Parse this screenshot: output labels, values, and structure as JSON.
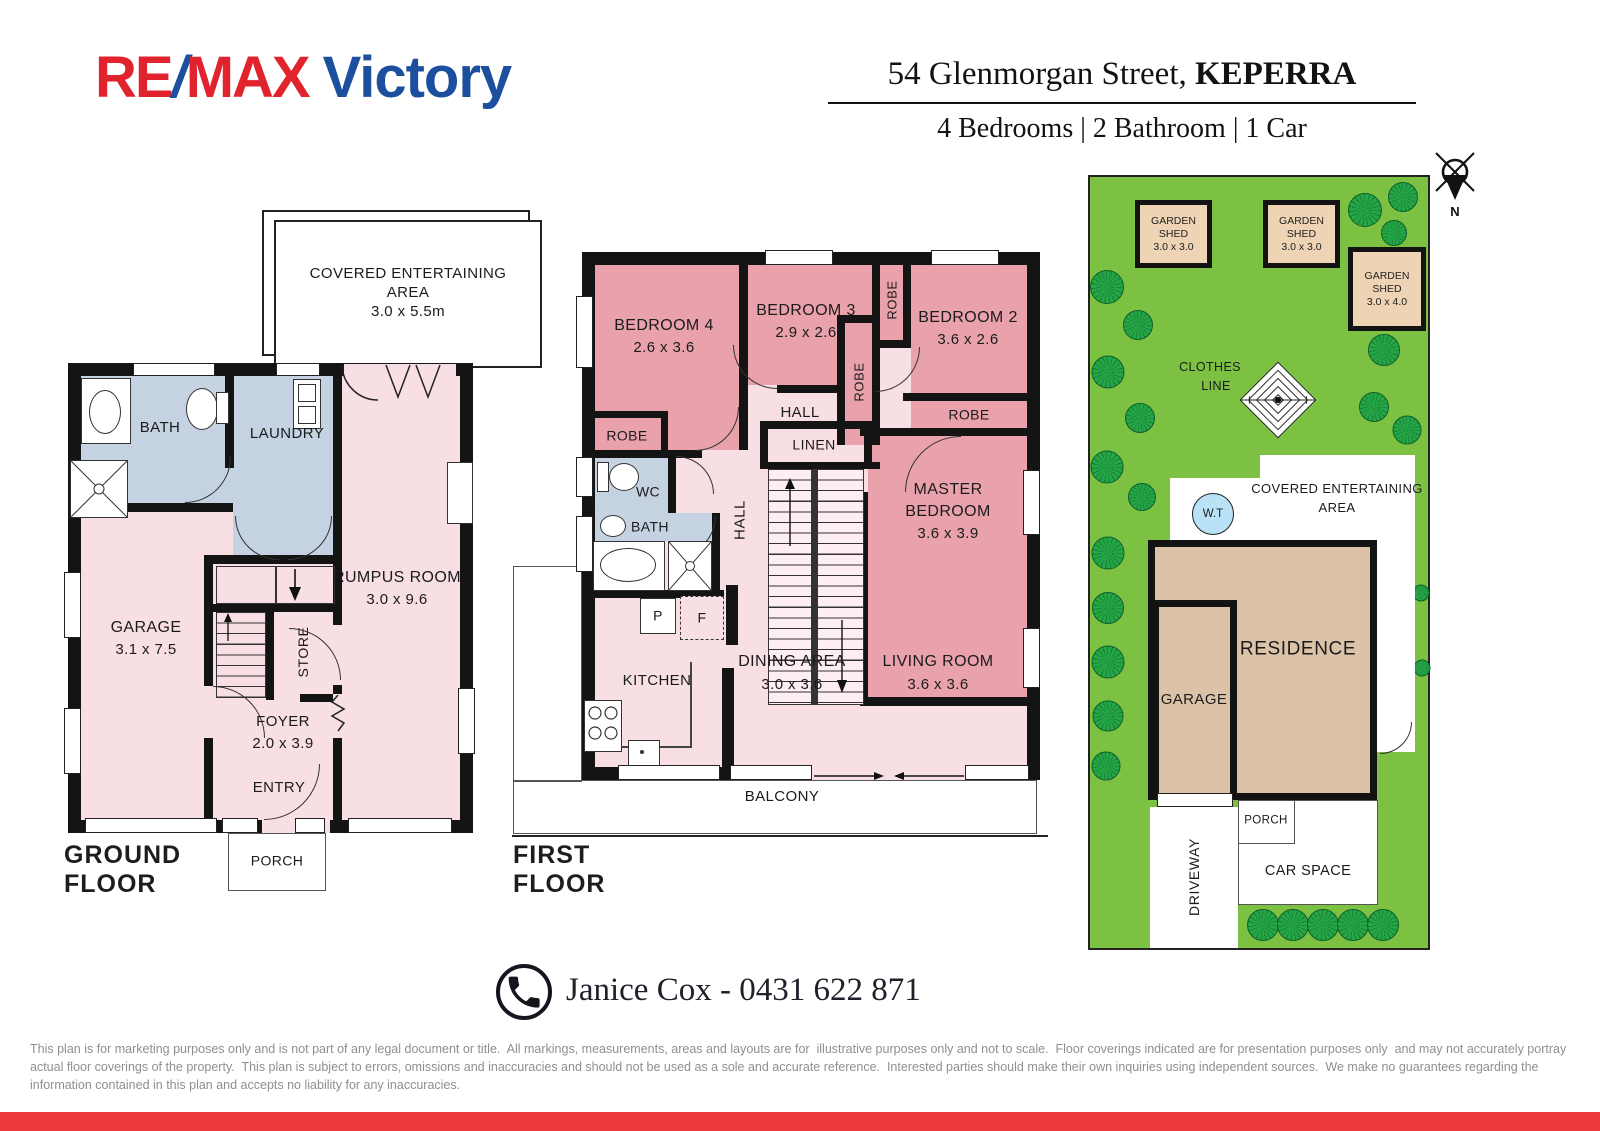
{
  "header": {
    "brand_re": "RE",
    "brand_slash": "/",
    "brand_max": "MAX",
    "brand_name": "Victory",
    "address": "54 Glenmorgan Street, ",
    "address_suburb": "KEPERRA",
    "summary": "4 Bedrooms | 2 Bathroom | 1 Car",
    "compass_north": "N"
  },
  "ground_floor": {
    "title": "GROUND FLOOR",
    "covered_area_line1": "COVERED ENTERTAINING",
    "covered_area_line2": "AREA",
    "covered_area_line3": "3.0 x 5.5m",
    "bath": "BATH",
    "laundry": "LAUNDRY",
    "garage": "GARAGE",
    "garage_dim": "3.1 x 7.5",
    "rumpus": "RUMPUS ROOM",
    "rumpus_dim": "3.0 x 9.6",
    "store": "STORE",
    "foyer": "FOYER",
    "foyer_dim": "2.0 x 3.9",
    "entry": "ENTRY",
    "porch": "PORCH"
  },
  "first_floor": {
    "title": "FIRST FLOOR",
    "bedroom4": "BEDROOM 4",
    "bedroom4_dim": "2.6 x 3.6",
    "bedroom3": "BEDROOM 3",
    "bedroom3_dim": "2.9 x 2.6",
    "bedroom2": "BEDROOM 2",
    "bedroom2_dim": "3.6 x 2.6",
    "robe": "ROBE",
    "hall": "HALL",
    "linen": "LINEN",
    "master_line1": "MASTER",
    "master_line2": "BEDROOM",
    "master_dim": "3.6 x 3.9",
    "wc": "WC",
    "bath": "BATH",
    "pantry": "P",
    "fridge": "F",
    "kitchen": "KITCHEN",
    "dining": "DINING AREA",
    "dining_dim": "3.0 x 3.6",
    "living": "LIVING ROOM",
    "living_dim": "3.6 x 3.6",
    "balcony": "BALCONY"
  },
  "site_plan": {
    "shed_line1": "GARDEN",
    "shed_line2": "SHED",
    "shed_small_dim": "3.0 x 3.0",
    "shed_large_dim": "3.0 x 4.0",
    "clothes_line1": "CLOTHES",
    "clothes_line2": "LINE",
    "water_tank": "W.T",
    "covered_line1": "COVERED ENTERTAINING",
    "covered_line2": "AREA",
    "residence": "RESIDENCE",
    "garage": "GARAGE",
    "porch": "PORCH",
    "car_space": "CAR SPACE",
    "driveway": "DRIVEWAY"
  },
  "contact": {
    "agent": "Janice Cox - 0431 622 871"
  },
  "disclaimer": {
    "line1": "This plan is for marketing purposes only and is not part of any legal document or title.  All markings, measurements, areas and layouts are for  illustrative purposes only and not to scale.  Floor coverings indicated are for presentation purposes only  and may not accurately portray",
    "line2": "actual floor coverings of the property.  This plan is subject to errors, omissions and inaccuracies and should not be used as a sole and accurate reference.  Interested parties should make their own inquiries using independent sources.  We make no guarantees regarding the",
    "line3": "information contained in this plan and accepts no liability for any inaccuracies."
  },
  "colors": {
    "brand_red": "#e0232d",
    "brand_blue": "#1c4f9e",
    "floor_light": "#f8dfe3",
    "floor_dark": "#e9a2ac",
    "wet_area": "#c5d2e2",
    "site_green": "#7cc142",
    "structure_tan": "#dcc3a8",
    "shed_tan": "#eed3b4",
    "water_blue": "#b9e2f7",
    "bottom_bar_red": "#ee3a3a"
  }
}
